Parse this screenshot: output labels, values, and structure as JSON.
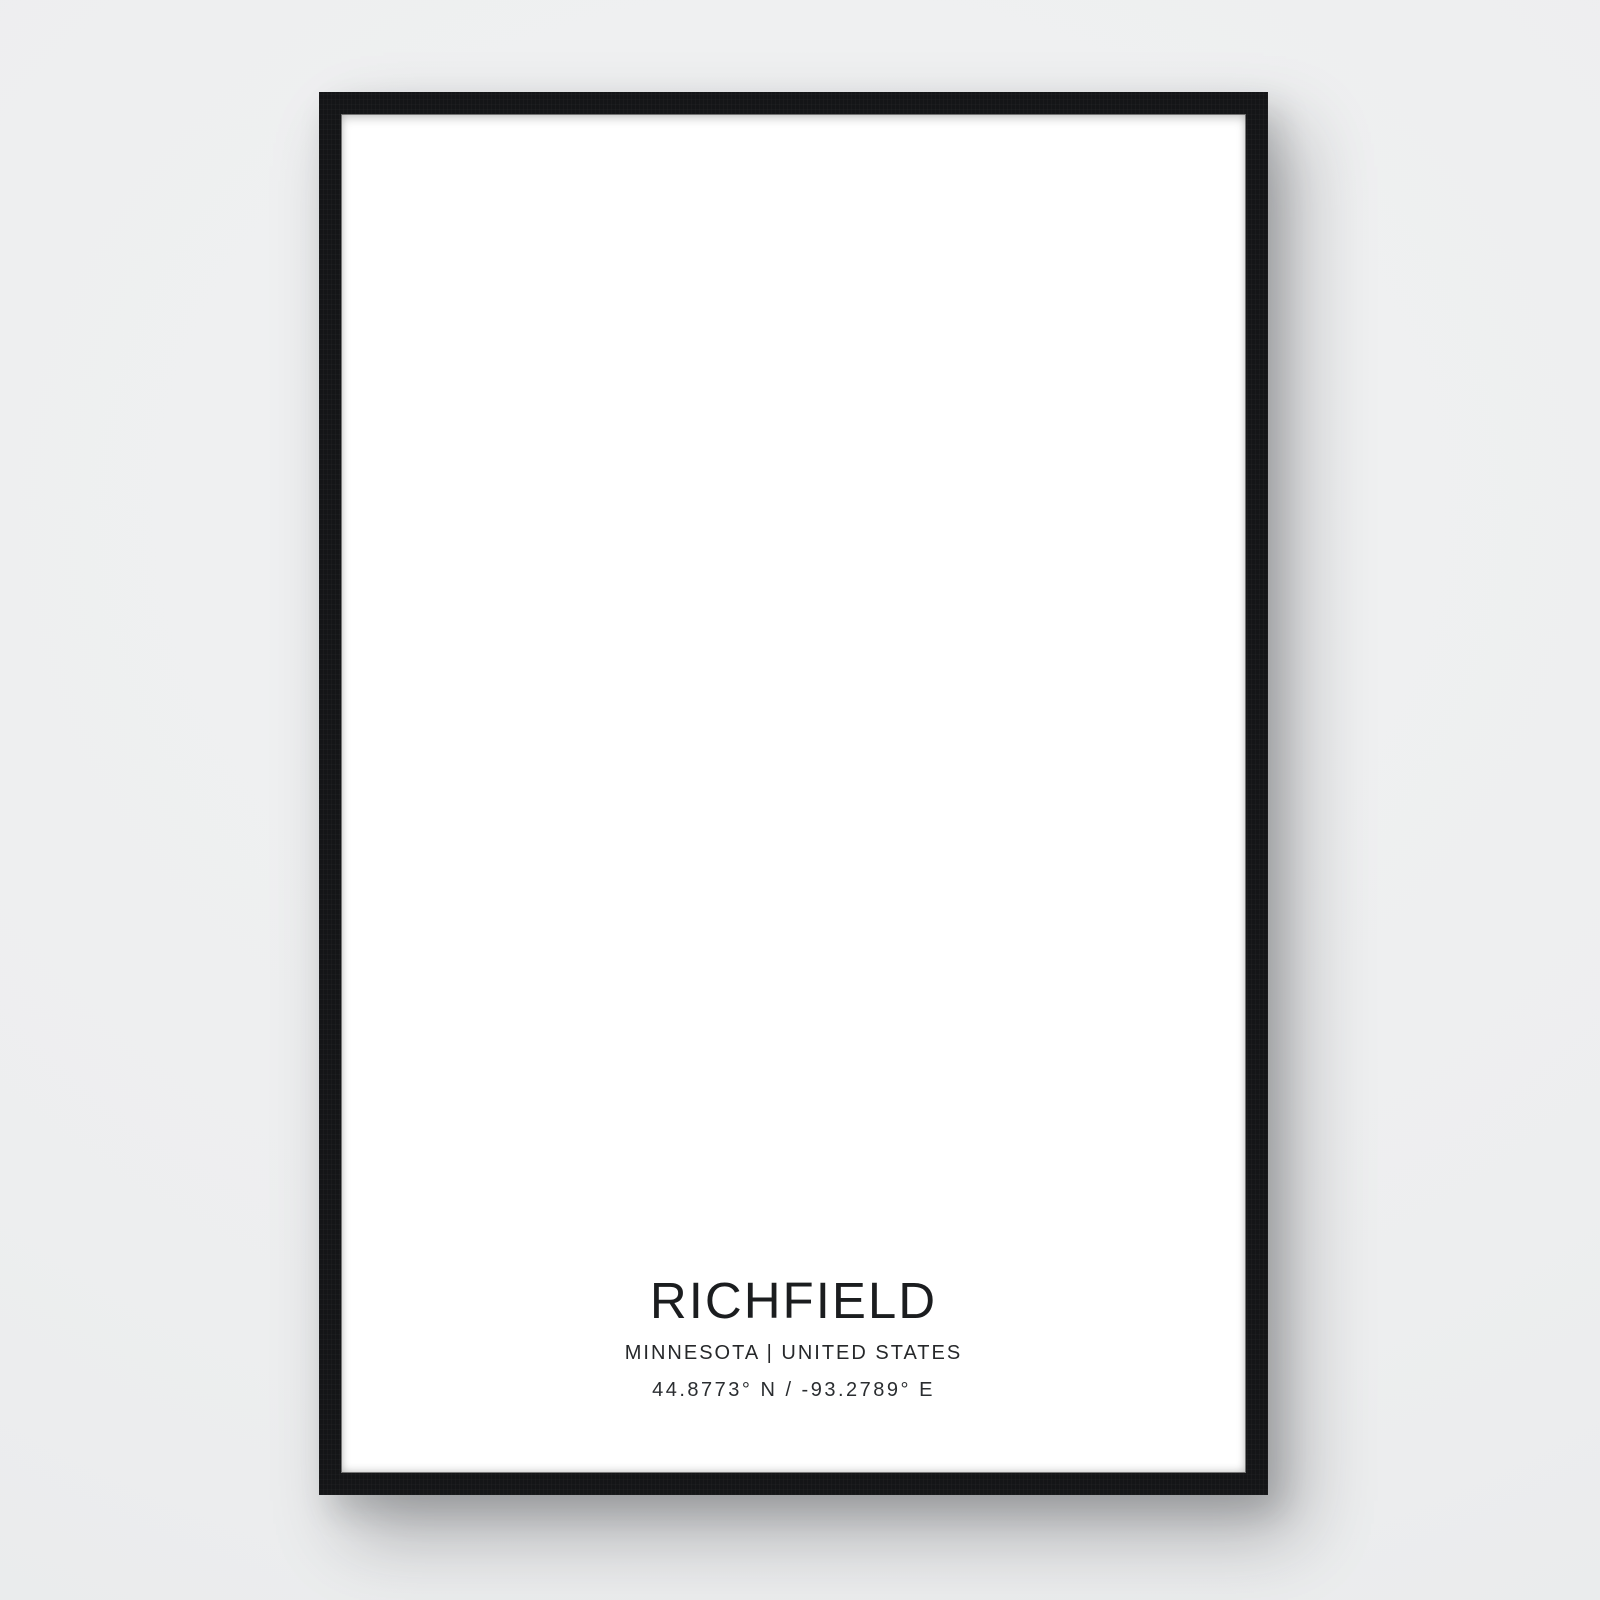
{
  "poster": {
    "city": "RICHFIELD",
    "region_line": "MINNESOTA | UNITED STATES",
    "coordinates": "44.8773° N / -93.2789° E"
  },
  "map": {
    "seed": 22,
    "colors": {
      "backdrop": "#eef0f1",
      "frame": "#141517",
      "poster_bg": "#ffffff",
      "water_fill": "#e8eaec",
      "water_stroke": "#44494e",
      "park_fill": "#f2f4f5",
      "minor_road": "#565b60",
      "arterial_road": "#2e3236",
      "heavy_road": "#1a1d1f",
      "highway": "#131517",
      "light_road": "#a7acb0",
      "tick": "#868b90",
      "cell_stroke": "#8e9398",
      "airport_stroke": "#7c8186",
      "runway_fill": "#e3e5e7"
    },
    "rect": {
      "x0": 37,
      "x1": 869,
      "y0": 36,
      "y1": 1196
    },
    "grid": {
      "minor_dx": 9.25,
      "minor_dy": 18.5,
      "art_dx": 37,
      "art_dy": 37,
      "art_x_start": 45,
      "art_y_start": 49
    },
    "exclusions": [
      {
        "t": "e",
        "cx": 257,
        "cy": 193,
        "rx": 79,
        "ry": 81,
        "rot": 0,
        "m": 0
      },
      {
        "t": "e",
        "cx": 299,
        "cy": 76,
        "rx": 104,
        "ry": 44,
        "rot": 0,
        "m": 0
      },
      {
        "t": "e",
        "cx": 730,
        "cy": 336,
        "rx": 80,
        "ry": 96,
        "rot": -16,
        "m": 0
      },
      {
        "t": "e",
        "cx": 787,
        "cy": 202,
        "rx": 27,
        "ry": 32,
        "rot": 0,
        "m": 1
      },
      {
        "t": "e",
        "cx": 535,
        "cy": 425,
        "rx": 30,
        "ry": 48,
        "rot": 0,
        "m": 1
      },
      {
        "t": "e",
        "cx": 358,
        "cy": 655,
        "rx": 52,
        "ry": 98,
        "rot": 0,
        "m": 1
      },
      {
        "t": "e",
        "cx": 259,
        "cy": 814,
        "rx": 34,
        "ry": 22,
        "rot": 0,
        "m": 1
      },
      {
        "t": "e",
        "cx": 230,
        "cy": 66,
        "rx": 32,
        "ry": 17,
        "rot": 0,
        "m": 1
      },
      {
        "t": "e",
        "cx": 99,
        "cy": 70,
        "rx": 22,
        "ry": 13,
        "rot": 0,
        "m": 1
      },
      {
        "t": "p",
        "pts": [
          [
            706,
            408
          ],
          [
            869,
            390
          ],
          [
            869,
            846
          ],
          [
            700,
            846
          ],
          [
            666,
            620
          ],
          [
            688,
            520
          ]
        ],
        "m": 0
      },
      {
        "t": "p",
        "pts": [
          [
            700,
            846
          ],
          [
            869,
            846
          ],
          [
            869,
            1196
          ],
          [
            700,
            1196
          ],
          [
            770,
            1020
          ]
        ],
        "m": 0
      },
      {
        "t": "p",
        "pts": [
          [
            829,
            36
          ],
          [
            869,
            36
          ],
          [
            869,
            116
          ]
        ],
        "m": 0
      }
    ],
    "parks": [
      {
        "cx": 257,
        "cy": 193,
        "rx": 84,
        "ry": 86
      },
      {
        "cx": 299,
        "cy": 76,
        "rx": 102,
        "ry": 42
      },
      {
        "cx": 740,
        "cy": 330,
        "rx": 88,
        "ry": 112
      },
      {
        "cx": 358,
        "cy": 655,
        "rx": 46,
        "ry": 92
      },
      {
        "cx": 120,
        "cy": 1135,
        "rx": 70,
        "ry": 45
      },
      {
        "cx": 380,
        "cy": 1170,
        "rx": 90,
        "ry": 38
      },
      {
        "cx": 780,
        "cy": 640,
        "rx": 95,
        "ry": 180
      }
    ],
    "lakes": [
      {
        "name": "lake-harriet",
        "d": "M196 150 C204 130 228 122 256 122 C288 122 312 132 322 156 C330 176 328 206 320 228 C310 254 288 266 260 264 C230 262 202 250 192 224 C184 202 188 170 196 150 Z"
      },
      {
        "name": "lake-nokomis",
        "d": "M706 262 C730 254 754 264 762 288 C768 308 780 324 786 346 C792 372 784 398 762 408 C738 418 714 408 704 384 C696 364 682 350 676 326 C668 294 682 270 706 262 Z"
      },
      {
        "name": "diamond-lake",
        "d": "M518 392 C526 384 548 384 554 396 C560 408 558 428 556 444 C554 460 544 468 532 464 C520 460 512 444 512 424 C512 408 512 398 518 392 Z"
      },
      {
        "name": "pond-nw",
        "d": "M206 56 C216 48 242 48 252 56 C260 63 258 74 246 78 C230 83 212 80 204 72 C199 67 200 61 206 56 Z"
      },
      {
        "name": "pond-far-nw",
        "d": "M84 64 C90 56 108 56 114 62 C120 68 116 78 106 80 C94 82 80 72 84 64 Z"
      },
      {
        "name": "pond-nokomis-ne",
        "d": "M766 176 C782 166 802 170 810 184 C817 196 814 214 800 222 C784 230 762 226 756 212 C750 200 754 184 766 176 Z"
      }
    ],
    "small_ponds": [
      {
        "cx": 244,
        "cy": 999,
        "rx": 16,
        "ry": 11
      },
      {
        "cx": 106,
        "cy": 1091,
        "rx": 12,
        "ry": 8
      },
      {
        "cx": 196,
        "cy": 962,
        "rx": 9,
        "ry": 7
      },
      {
        "cx": 380,
        "cy": 1105,
        "rx": 13,
        "ry": 9
      },
      {
        "cx": 540,
        "cy": 1120,
        "rx": 10,
        "ry": 7
      },
      {
        "cx": 49,
        "cy": 121,
        "rx": 8,
        "ry": 12
      },
      {
        "cx": 350,
        "cy": 566,
        "rx": 9,
        "ry": 7
      }
    ],
    "park_ponds": [
      {
        "cx": 352,
        "cy": 618,
        "r": 11
      },
      {
        "cx": 362,
        "cy": 700,
        "r": 9
      }
    ],
    "rings": [
      {
        "cx": 257,
        "cy": 193,
        "rx": 77,
        "ry": 79,
        "rot": 0
      },
      {
        "cx": 730,
        "cy": 336,
        "rx": 74,
        "ry": 87,
        "rot": -14
      }
    ],
    "creeks": {
      "north": "M206 36 Q198 60 208 84 Q216 104 206 122 L204 132",
      "east": "M306 250 Q330 268 342 296 Q352 318 372 327 Q392 336 410 327 Q430 318 448 330 Q466 342 486 334 Q506 326 524 338 Q542 350 562 341 Q580 332 598 340 Q616 348 634 337 Q650 327 664 334 L672 336",
      "northeast": "M782 262 Q800 244 822 236 Q844 228 860 218 L869 214",
      "offshoots": [
        "M410 327 Q420 346 440 350 Q458 354 470 344",
        "M486 334 Q492 316 510 312 Q526 309 536 318"
      ],
      "islands": [
        {
          "cx": 432,
          "cy": 338,
          "r": 4
        },
        {
          "cx": 500,
          "cy": 324,
          "r": 3.5
        },
        {
          "cx": 556,
          "cy": 348,
          "r": 3
        }
      ]
    },
    "highways": {
      "hw35n": "M489 36 L489 210 C489 300 487 380 483 446 C480 492 468 514 446 522 C428 528 408 531 388 531",
      "hw35n2": "M494 36 L494 210 C494 300 492 380 488 446",
      "hw35s": "M358 531 C330 538 318 560 314 600 C310 640 306 660 306 700 L306 790 C306 830 308 860 312 896 C317 940 327 984 339 1022 C349 1056 355 1092 357 1130 C358 1156 357 1180 355 1196",
      "hw62": "M37 578 C72 558 100 544 132 536 C164 528 210 531 248 531 L618 529 C648 528 666 521 676 513 C694 499 722 489 756 483 C794 477 832 473 869 469",
      "i494": "M37 851 C140 849 260 848 360 848 L560 848 C680 848 790 850 869 850",
      "hw77": "M680 458 C688 482 692 520 693 560 L695 720 L695 848 C695 906 702 956 716 1004 C731 1056 753 1104 778 1146 C790 1166 798 1182 804 1196",
      "hw772": "M686 458 C694 482 698 520 699 560 L701 720",
      "cedar_n": "M681 36 L679 456",
      "hw55": "M829 36 L871 116",
      "hw55_par": [
        "M845 36 L869 82",
        "M858 36 L869 57"
      ],
      "hw55_ticks": "M836 50 L850 42 M842 62 L858 52 M850 74 L866 64",
      "frontage_494a": "M37 833 L869 833",
      "frontage_494b": "M37 866 L869 866",
      "frontage_62": "M60 552 C100 540 140 544 180 545 L620 543"
    },
    "ramps": [
      {
        "cx": 292,
        "cy": 834,
        "r": 9
      },
      {
        "cx": 318,
        "cy": 836,
        "r": 9
      },
      {
        "cx": 293,
        "cy": 864,
        "r": 9
      },
      {
        "cx": 319,
        "cy": 864,
        "r": 9
      },
      {
        "cx": 683,
        "cy": 833,
        "r": 10
      },
      {
        "cx": 709,
        "cy": 835,
        "r": 9
      },
      {
        "cx": 683,
        "cy": 865,
        "r": 9
      },
      {
        "cx": 711,
        "cy": 865,
        "r": 10
      },
      {
        "cx": 55,
        "cy": 837,
        "r": 9
      },
      {
        "cx": 68,
        "cy": 863,
        "r": 9
      },
      {
        "cx": 340,
        "cy": 517,
        "r": 9
      },
      {
        "cx": 358,
        "cy": 545,
        "r": 8
      },
      {
        "cx": 660,
        "cy": 499,
        "r": 9
      },
      {
        "cx": 688,
        "cy": 531,
        "r": 9
      },
      {
        "cx": 700,
        "cy": 512,
        "r": 11
      }
    ],
    "airport": {
      "bounds": [
        "M704 430 C718 462 712 504 688 540 C670 566 664 592 670 618 C682 660 690 704 692 746 L694 844",
        "M704 430 C752 420 804 412 869 406",
        "M704 848 C744 872 784 904 814 944 C844 986 860 1034 868 1082"
      ],
      "inner": [
        "M718 468 C756 486 794 514 824 548 C846 574 860 600 868 626",
        "M700 624 C742 636 778 658 806 688 C826 710 842 736 852 762"
      ],
      "curl": "M746 560 C792 550 826 566 832 598 C836 622 820 640 796 638 C780 636 772 624 776 610",
      "runways": [
        {
          "poly": "M756 590 L842 652 L835 662 L749 600 Z",
          "line": "M752 598 L838 660"
        },
        {
          "poly": "M722 708 L796 648 L802 656 L728 716 Z",
          "line": "M726 712 L800 652"
        },
        {
          "poly": "M790 1002 L852 1090 L842 1097 L780 1009 Z",
          "line": "M785 1006 L847 1094"
        }
      ]
    },
    "fan_roads": [
      "M226 450 Q238 490 230 530",
      "M234 448 Q246 488 238 528",
      "M242 446 Q254 486 246 526",
      "M250 444 Q262 484 254 524"
    ],
    "west_curves": [
      "M168 80 Q150 135 172 190 Q188 230 178 272",
      "M156 84 Q140 138 160 192 Q174 228 166 268",
      "M180 78 Q164 134 184 188 Q198 226 190 266"
    ],
    "white_blocks": [
      {
        "x": 77,
        "y": 608,
        "w": 54,
        "h": 58,
        "hatch": 1
      },
      {
        "x": 709,
        "y": 888,
        "w": 66,
        "h": 58,
        "hatch": 1
      },
      {
        "x": 560,
        "y": 70,
        "w": 46,
        "h": 30,
        "hatch": 0
      },
      {
        "x": 586,
        "y": 178,
        "w": 40,
        "h": 26,
        "hatch": 0
      },
      {
        "x": 196,
        "y": 560,
        "w": 34,
        "h": 24,
        "hatch": 0
      },
      {
        "x": 770,
        "y": 516,
        "w": 52,
        "h": 38,
        "hatch": 0
      }
    ],
    "curvy_zones": [
      {
        "x0": 40,
        "y0": 880,
        "x1": 300,
        "y1": 1180,
        "n": 60,
        "light": 0
      },
      {
        "x0": 40,
        "y0": 300,
        "x1": 100,
        "y1": 880,
        "n": 26,
        "light": 0
      },
      {
        "x0": 110,
        "y0": 560,
        "x1": 150,
        "y1": 870,
        "n": 10,
        "light": 0
      },
      {
        "x0": 300,
        "y0": 1060,
        "x1": 700,
        "y1": 1190,
        "n": 30,
        "light": 0
      },
      {
        "x0": 705,
        "y0": 860,
        "x1": 865,
        "y1": 1150,
        "n": 22,
        "light": 0
      },
      {
        "x0": 710,
        "y0": 450,
        "x1": 860,
        "y1": 830,
        "n": 10,
        "light": 1
      },
      {
        "x0": 150,
        "y0": 60,
        "x1": 215,
        "y1": 290,
        "n": 8,
        "light": 0
      }
    ],
    "loops_zone": {
      "x0": 50,
      "y0": 900,
      "x1": 280,
      "y1": 1150,
      "n": 12
    },
    "cells": {
      "cx": 299,
      "cy": 76,
      "rx": 96,
      "ry": 36,
      "n": 18
    },
    "ticks": 680,
    "fade": {
      "cx": 453,
      "cy": 1192,
      "r": 360,
      "squash": 0.32
    }
  }
}
